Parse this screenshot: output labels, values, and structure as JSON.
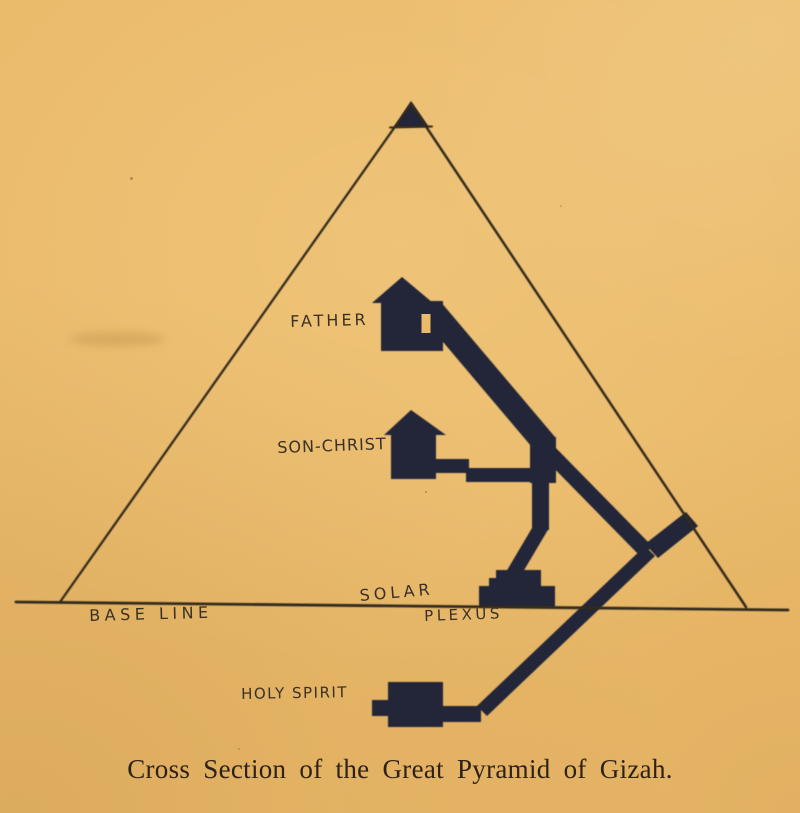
{
  "colors": {
    "paper": "#eab969",
    "ink": "#212637",
    "line_ink": "#33291d",
    "label_ink": "#3a3126",
    "caption_ink": "#2e2118"
  },
  "diagram": {
    "labels": {
      "father": "FATHER",
      "son_christ": "SON-CHRIST",
      "solar": "SOLAR",
      "plexus": "PLEXUS",
      "base_line": "BASE LINE",
      "holy_spirit": "HOLY SPIRIT"
    },
    "shapes": [
      "pyramid-outline",
      "apex-capstone",
      "base-line",
      "father-chamber",
      "son-christ-chamber",
      "grand-gallery",
      "ascending-passage",
      "entrance-passage",
      "descending-passage",
      "well-shaft",
      "solar-plexus-mound",
      "holy-spirit-chamber"
    ]
  },
  "caption": "Cross Section of the Great Pyramid of Gizah."
}
